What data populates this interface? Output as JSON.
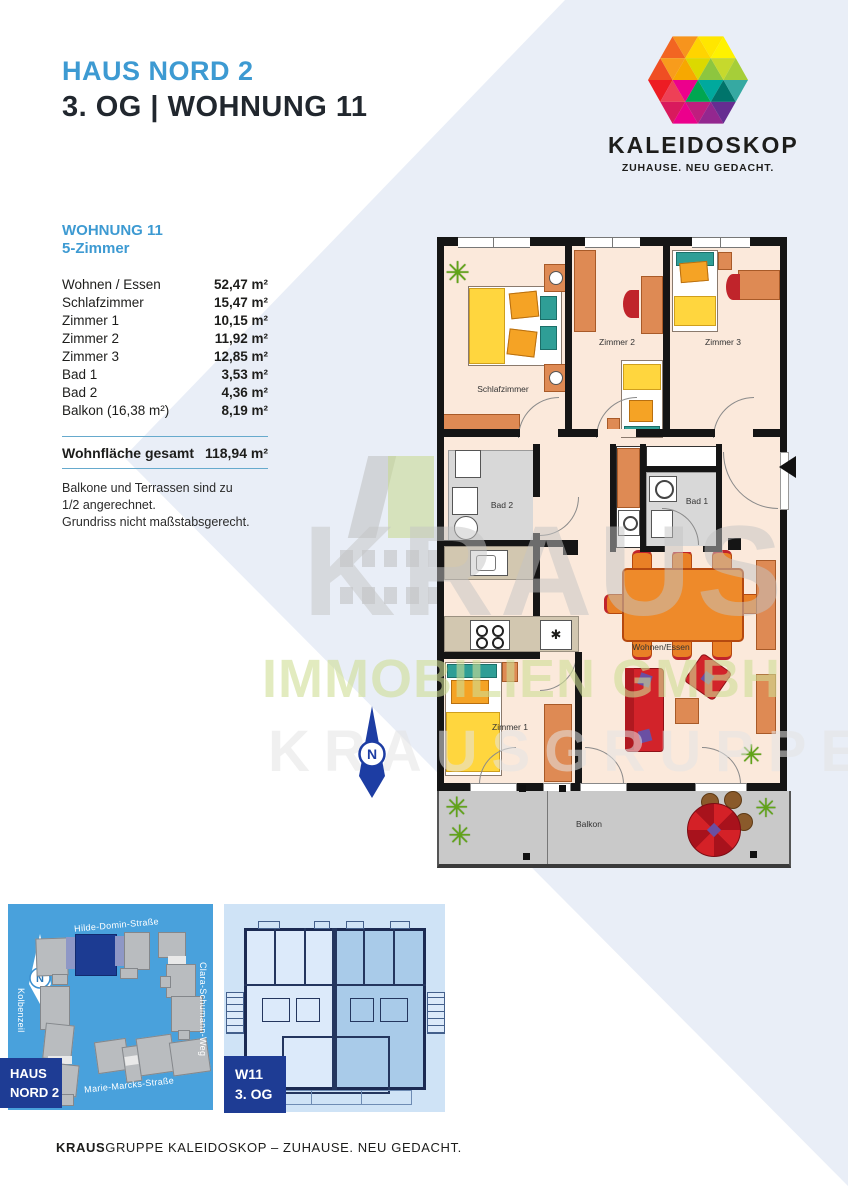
{
  "header": {
    "building": "HAUS NORD 2",
    "unit_line": "3. OG | WOHNUNG 11"
  },
  "logo": {
    "name": "KALEIDOSKOP",
    "tagline": "ZUHAUSE. NEU GEDACHT."
  },
  "unit_panel": {
    "title": "WOHNUNG 11",
    "subtitle": "5-Zimmer",
    "rooms": [
      {
        "label": "Wohnen / Essen",
        "area": "52,47 m²"
      },
      {
        "label": "Schlafzimmer",
        "area": "15,47 m²"
      },
      {
        "label": "Zimmer 1",
        "area": "10,15 m²"
      },
      {
        "label": "Zimmer 2",
        "area": "11,92 m²"
      },
      {
        "label": "Zimmer 3",
        "area": "12,85 m²"
      },
      {
        "label": "Bad 1",
        "area": "3,53 m²"
      },
      {
        "label": "Bad 2",
        "area": "4,36 m²"
      },
      {
        "label": "Balkon (16,38 m²)",
        "area": "8,19 m²"
      }
    ],
    "total_label": "Wohnfläche gesamt",
    "total_area": "118,94 m²",
    "notes": [
      "Balkone und Terrassen sind zu",
      "1/2 angerechnet.",
      "Grundriss nicht maßstabsgerecht."
    ]
  },
  "floorplan": {
    "labels": {
      "schlafzimmer": "Schlafzimmer",
      "zimmer2": "Zimmer 2",
      "zimmer3": "Zimmer 3",
      "bad2": "Bad 2",
      "bad1": "Bad 1",
      "wohnen_essen": "Wohnen/Essen",
      "zimmer1": "Zimmer 1",
      "balkon": "Balkon"
    },
    "stove_symbol": "✱",
    "plant_symbol": "✳",
    "north_label": "N"
  },
  "watermark": {
    "line1": "KRAUS",
    "line2": "IMMOBILIEN GMBH",
    "line3": "KRAUSGRUPPE"
  },
  "site_map": {
    "streets": {
      "top": "Hilde-Domin-Straße",
      "right": "Clara-Schumann-Weg",
      "bottom": "Marie-Marcks-Straße",
      "left": "Kolbenzeil"
    },
    "north_label": "N",
    "haus_line1": "HAUS",
    "haus_line2": "NORD 2"
  },
  "unit_map": {
    "label_line1": "W11",
    "label_line2": "3. OG"
  },
  "footer": {
    "brand_bold": "KRAUS",
    "rest": "GRUPPE  KALEIDOSKOP – ZUHAUSE. NEU GEDACHT."
  },
  "colors": {
    "accent_blue": "#3d9ad2",
    "navy": "#1e3c94",
    "band": "#e9eef7",
    "map_blue": "#49a1dc"
  }
}
